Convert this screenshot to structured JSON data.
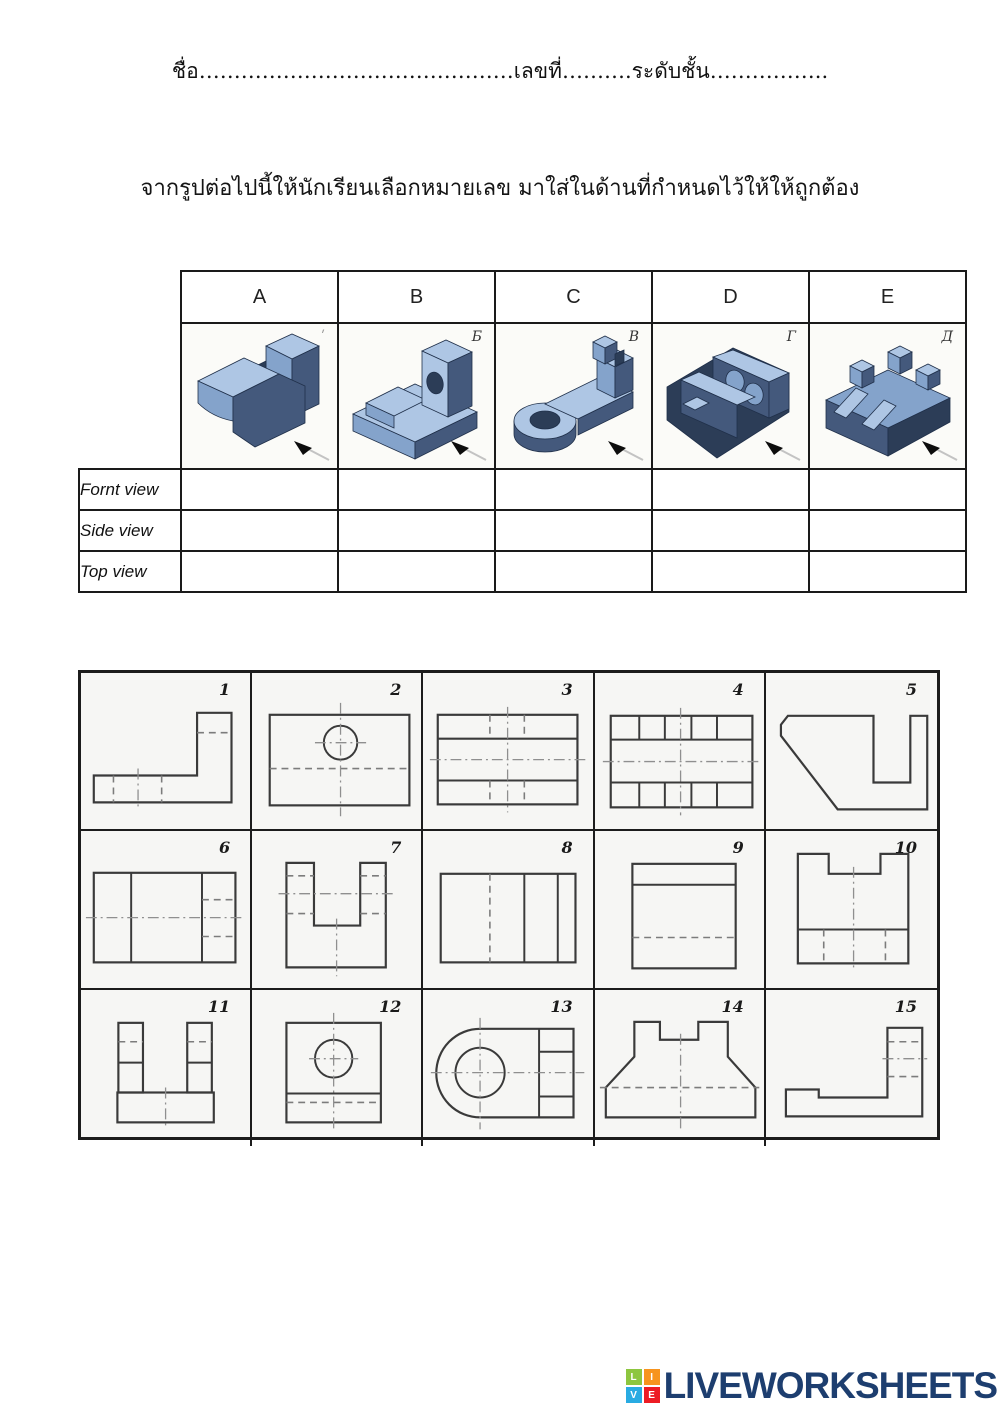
{
  "header": {
    "name_line": "ชื่อ………………………………………เลขที่……….ระดับชั้น……………..",
    "instruction": "จากรูปต่อไปนี้ให้นักเรียนเลือกหมายเลข มาใส่ในด้านที่กำหนดไว้ให้ให้ถูกต้อง"
  },
  "table": {
    "columns": [
      "A",
      "B",
      "C",
      "D",
      "E"
    ],
    "part_labels": [
      "ʹ",
      "Б",
      "В",
      "Г",
      "Д"
    ],
    "row_labels": [
      "Fornt view",
      "Side view",
      "Top view"
    ],
    "answers": [
      "",
      "",
      "",
      "",
      "",
      "",
      "",
      "",
      "",
      "",
      "",
      "",
      "",
      "",
      ""
    ]
  },
  "grid": {
    "numbers": [
      "1",
      "2",
      "3",
      "4",
      "5",
      "6",
      "7",
      "8",
      "9",
      "10",
      "11",
      "12",
      "13",
      "14",
      "15"
    ]
  },
  "footer": {
    "logo_text": "LIVEWORKSHEETS",
    "logo_color": "#1d3e6f",
    "squares": [
      {
        "letter": "L",
        "color": "#8dc63f"
      },
      {
        "letter": "I",
        "color": "#f7941e"
      },
      {
        "letter": "V",
        "color": "#29abe2"
      },
      {
        "letter": "E",
        "color": "#ed1c24"
      }
    ]
  }
}
